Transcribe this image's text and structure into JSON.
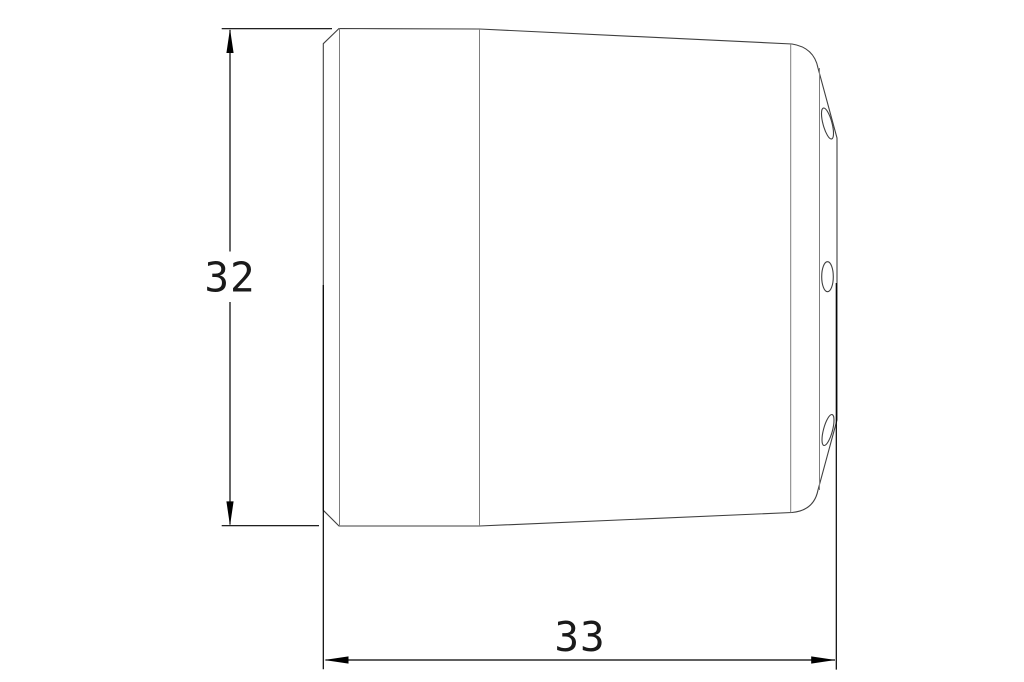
{
  "drawing": {
    "title": "part-side-view-technical-drawing",
    "dimensions": {
      "height": {
        "value": "32"
      },
      "width": {
        "value": "33"
      }
    },
    "colors": {
      "background": "#ffffff",
      "outline": "#3f3f3f",
      "inner_lines": "#7e7e7e",
      "dimension_lines": "#000000",
      "text": "#1a1a1a"
    }
  }
}
